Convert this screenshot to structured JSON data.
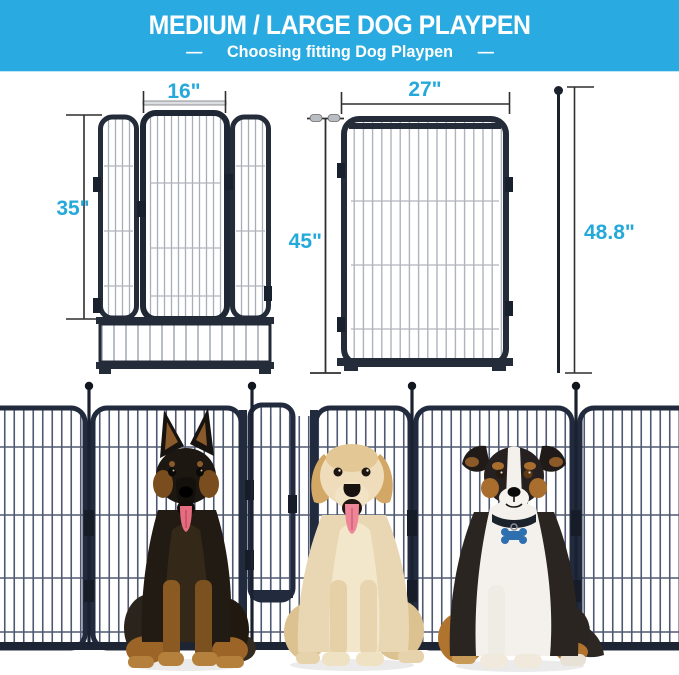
{
  "header": {
    "title": "MEDIUM / LARGE DOG PLAYPEN",
    "subtitle": "Choosing fitting Dog Playpen",
    "dash_left": "—",
    "dash_right": "—",
    "bg_color": "#29abe2",
    "text_color": "#ffffff"
  },
  "diagrams": {
    "accent_color": "#25a9da",
    "gate_panel": {
      "door_width_label": "16\"",
      "height_label": "35\""
    },
    "large_panel": {
      "width_label": "27\"",
      "height_label": "45\"",
      "stake_height_label": "48.8\""
    }
  },
  "photo": {
    "fence_color": "#222b3e",
    "dogs": [
      "german-shepherd",
      "golden-retriever",
      "australian-shepherd"
    ]
  }
}
